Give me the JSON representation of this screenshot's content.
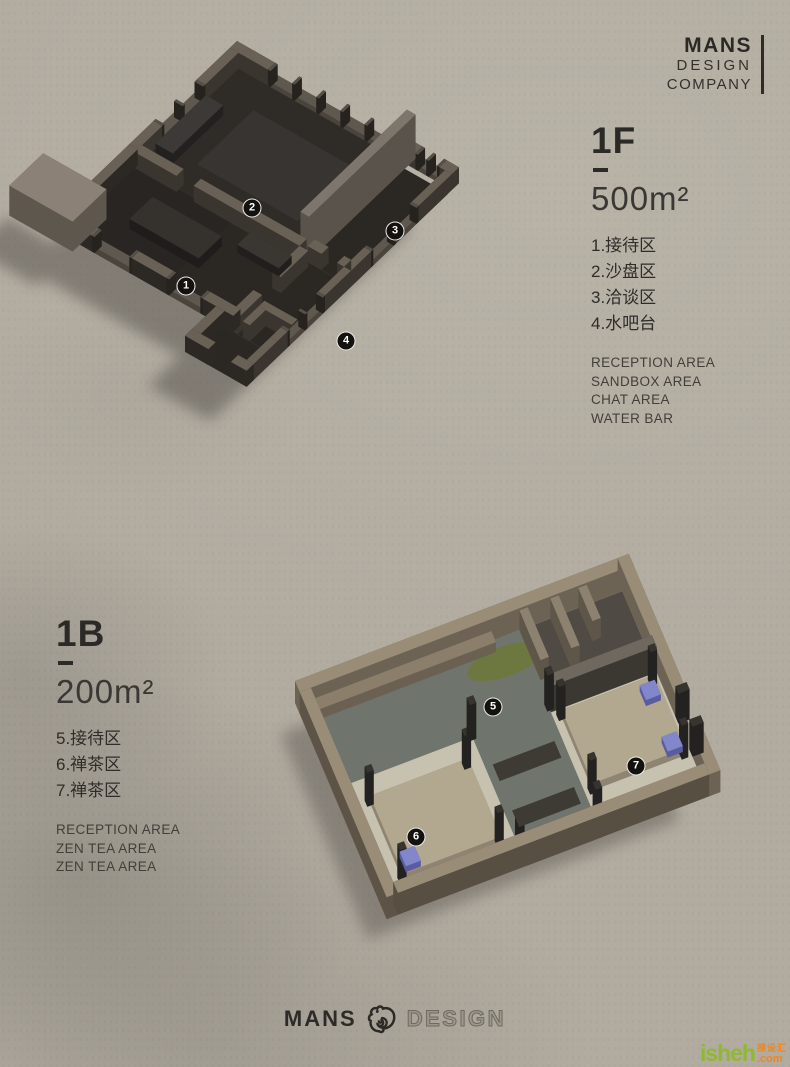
{
  "logo_top": {
    "line1": "MANS",
    "line2": "DESIGN",
    "line3": "COMPANY"
  },
  "floor1": {
    "code": "1F",
    "area": "500m²",
    "items_cn": [
      "1.接待区",
      "2.沙盘区",
      "3.洽谈区",
      "4.水吧台"
    ],
    "items_en": [
      "RECEPTION AREA",
      "SANDBOX AREA",
      "CHAT AREA",
      "WATER BAR"
    ]
  },
  "floor2": {
    "code": "1B",
    "area": "200m²",
    "items_cn": [
      "5.接待区",
      "6.禅茶区",
      "7.禅茶区"
    ],
    "items_en": [
      "RECEPTION AREA",
      "ZEN TEA AREA",
      "ZEN TEA AREA"
    ]
  },
  "footer": {
    "brand": "MANS",
    "brand2": "DESIGN",
    "icon": "chameleon-logo"
  },
  "watermark": {
    "main": "isheh",
    "tld": ".com",
    "cn": "搜设汇"
  },
  "colors": {
    "paper": "#b1aba0",
    "ink": "#2c2a27",
    "marker_bg": "#14120f",
    "wm_green": "#8fb92e",
    "wm_orange": "#f0861c"
  },
  "markers": [
    {
      "n": "1",
      "x": 186,
      "y": 286
    },
    {
      "n": "2",
      "x": 252,
      "y": 208
    },
    {
      "n": "3",
      "x": 395,
      "y": 231
    },
    {
      "n": "4",
      "x": 346,
      "y": 341
    },
    {
      "n": "5",
      "x": 493,
      "y": 707
    },
    {
      "n": "6",
      "x": 416,
      "y": 837
    },
    {
      "n": "7",
      "x": 636,
      "y": 766
    }
  ],
  "plans": [
    {
      "name": "floor-plan-1f",
      "origin": [
        237,
        57
      ],
      "u": [
        0.867,
        0.493
      ],
      "v": [
        -0.72,
        0.69
      ],
      "shadow": {
        "dx": -36,
        "dy": 34,
        "color": "#46423c",
        "opacity": 0.45
      },
      "colors": {
        "side": "#3a352f",
        "top": "#6a6156",
        "sillSide": "#4a443c",
        "sillTop": "#5f584f",
        "postSide": "#26231f",
        "postTop": "#55504a"
      },
      "shapes": [
        {
          "t": "slab",
          "r": [
            8,
            8,
            200,
            150
          ],
          "f": "#2f2c28",
          "sh": 1
        },
        {
          "t": "slab",
          "r": [
            200,
            15,
            256,
            150
          ],
          "f": "#2b2824",
          "sh": 1
        },
        {
          "t": "slab",
          "r": [
            8,
            150,
            205,
            252
          ],
          "f": "#282522",
          "sh": 1
        },
        {
          "t": "slab",
          "r": [
            120,
            150,
            256,
            252
          ],
          "f": "#2b2824",
          "sh": 1
        },
        {
          "t": "slab",
          "r": [
            185,
            252,
            256,
            295
          ],
          "f": "#2b2824",
          "sh": 1
        },
        {
          "t": "slab",
          "r": [
            52,
            40,
            168,
            118
          ],
          "f": "#373431"
        },
        {
          "t": "box",
          "r": [
            0,
            0,
            44,
            10
          ],
          "h": 16
        },
        {
          "t": "fence",
          "r": [
            44,
            0,
            186,
            10
          ],
          "sill": 5,
          "n": 6,
          "h": 16
        },
        {
          "t": "box",
          "r": [
            186,
            0,
            214,
            10
          ],
          "h": 16
        },
        {
          "t": "fence",
          "r": [
            214,
            0,
            242,
            10
          ],
          "sill": 5,
          "n": 3,
          "h": 16
        },
        {
          "t": "box",
          "r": [
            242,
            0,
            256,
            10
          ],
          "h": 16
        },
        {
          "t": "box",
          "r": [
            0,
            10,
            10,
            56
          ],
          "h": 16
        },
        {
          "t": "fence",
          "r": [
            0,
            56,
            10,
            116
          ],
          "sill": 5,
          "n": 3,
          "h": 16
        },
        {
          "t": "box",
          "r": [
            0,
            116,
            10,
            150
          ],
          "h": 16
        },
        {
          "t": "box",
          "r": [
            248,
            10,
            256,
            56
          ],
          "h": 16
        },
        {
          "t": "fence",
          "r": [
            248,
            56,
            256,
            122
          ],
          "sill": 6,
          "n": 3,
          "h": 16
        },
        {
          "t": "box",
          "r": [
            248,
            122,
            256,
            150
          ],
          "h": 16
        },
        {
          "t": "box",
          "r": [
            14,
            60,
            34,
            130
          ],
          "h": 10,
          "side": "#232120",
          "top": "#3c3936"
        },
        {
          "t": "box",
          "r": [
            196,
            0,
            206,
            148
          ],
          "h": 44,
          "side": "#59534c",
          "top": "#7d766c"
        },
        {
          "t": "box",
          "r": [
            8,
            144,
            58,
            154
          ],
          "h": 16
        },
        {
          "t": "box",
          "r": [
            78,
            144,
            200,
            154
          ],
          "h": 16
        },
        {
          "t": "box",
          "r": [
            206,
            140,
            222,
            150
          ],
          "h": 16
        },
        {
          "t": "box",
          "r": [
            240,
            140,
            248,
            150
          ],
          "h": 16
        },
        {
          "t": "box",
          "r": [
            200,
            154,
            210,
            192
          ],
          "h": 16
        },
        {
          "t": "box",
          "r": [
            200,
            218,
            210,
            252
          ],
          "h": 16
        },
        {
          "t": "box",
          "r": [
            216,
            222,
            254,
            230
          ],
          "h": 16
        },
        {
          "t": "box",
          "r": [
            216,
            230,
            224,
            252
          ],
          "h": 16
        },
        {
          "t": "box",
          "r": [
            52,
            180,
            132,
            212
          ],
          "h": 10,
          "side": "#1f1d1b",
          "top": "#35322e"
        },
        {
          "t": "box",
          "r": [
            148,
            160,
            196,
            178
          ],
          "h": 8,
          "side": "#211f1d",
          "top": "#3a3733"
        },
        {
          "t": "box",
          "r": [
            0,
            150,
            10,
            252
          ],
          "h": 16,
          "side": "#2c2925"
        },
        {
          "t": "box",
          "r": [
            0,
            242,
            42,
            252
          ],
          "h": 16,
          "side": "#2c2925"
        },
        {
          "t": "fence",
          "r": [
            42,
            242,
            88,
            252
          ],
          "sill": 6,
          "n": 2,
          "h": 16
        },
        {
          "t": "box",
          "r": [
            88,
            242,
            128,
            252
          ],
          "h": 16,
          "side": "#2c2925"
        },
        {
          "t": "fence",
          "r": [
            128,
            242,
            170,
            252
          ],
          "sill": 6,
          "n": 2,
          "h": 16
        },
        {
          "t": "box",
          "r": [
            170,
            242,
            205,
            252
          ],
          "h": 16,
          "side": "#2c2925"
        },
        {
          "t": "box",
          "r": [
            248,
            150,
            256,
            186
          ],
          "h": 16
        },
        {
          "t": "fence",
          "r": [
            248,
            186,
            256,
            238
          ],
          "sill": 6,
          "n": 3,
          "h": 16
        },
        {
          "t": "box",
          "r": [
            248,
            238,
            256,
            252
          ],
          "h": 16
        },
        {
          "t": "box",
          "r": [
            248,
            252,
            256,
            295
          ],
          "h": 16
        },
        {
          "t": "box",
          "r": [
            185,
            252,
            195,
            295
          ],
          "h": 16,
          "side": "#2c2925"
        },
        {
          "t": "box",
          "r": [
            185,
            285,
            212,
            295
          ],
          "h": 16,
          "side": "#2c2925"
        },
        {
          "t": "box",
          "r": [
            238,
            285,
            256,
            295
          ],
          "h": 16,
          "side": "#2c2925"
        },
        {
          "t": "box",
          "r": [
            -45,
            215,
            28,
            262
          ],
          "h": 30,
          "side": "#5e574d",
          "top": "#8b8177",
          "sh": 1
        }
      ]
    },
    {
      "name": "floor-plan-1b",
      "origin": [
        295,
        703
      ],
      "u": [
        0.935,
        -0.356
      ],
      "v": [
        0.39,
        0.92
      ],
      "shadow": {
        "dx": -30,
        "dy": 24,
        "color": "#46423c",
        "opacity": 0.38
      },
      "colors": {
        "side": "#6d6354",
        "top": "#9a8d78",
        "sillSide": "#6d6354",
        "sillTop": "#9a8d78",
        "postSide": "#242220",
        "postTop": "#37342f"
      },
      "shapes": [
        {
          "t": "slab",
          "r": [
            12,
            12,
            345,
            95
          ],
          "f": "#6f746c",
          "sh": 1
        },
        {
          "t": "slab",
          "r": [
            150,
            95,
            232,
            235
          ],
          "f": "#6f746c",
          "sh": 1
        },
        {
          "t": "slab",
          "r": [
            12,
            95,
            150,
            235
          ],
          "f": "#c7c1b0",
          "sh": 1
        },
        {
          "t": "slab",
          "r": [
            232,
            95,
            345,
            235
          ],
          "f": "#c7c1b0",
          "sh": 1
        },
        {
          "t": "slab",
          "r": [
            240,
            12,
            345,
            66
          ],
          "f": "#4f4a43"
        },
        {
          "t": "oval",
          "c": [
            210,
            36
          ],
          "rx": 40,
          "ry": 15,
          "f": "#6d7840"
        },
        {
          "t": "box",
          "r": [
            0,
            0,
            357,
            12
          ],
          "h": 22
        },
        {
          "t": "box",
          "r": [
            12,
            12,
            205,
            24
          ],
          "h": 10,
          "side": "#6b6153",
          "top": "#8b7f6b"
        },
        {
          "t": "box",
          "r": [
            235,
            12,
            244,
            66
          ],
          "h": 20,
          "side": "#5f564a",
          "top": "#8d8170"
        },
        {
          "t": "box",
          "r": [
            268,
            12,
            277,
            66
          ],
          "h": 20,
          "side": "#5f564a",
          "top": "#8d8170"
        },
        {
          "t": "box",
          "r": [
            298,
            12,
            307,
            48
          ],
          "h": 20,
          "side": "#5f564a",
          "top": "#8d8170"
        },
        {
          "t": "box",
          "r": [
            345,
            0,
            357,
            148
          ],
          "h": 22
        },
        {
          "t": "box",
          "r": [
            345,
            192,
            357,
            235
          ],
          "h": 22
        },
        {
          "t": "box",
          "r": [
            345,
            148,
            357,
            156
          ],
          "h": 30,
          "side": "#242220",
          "top": "#37342f"
        },
        {
          "t": "box",
          "r": [
            345,
            184,
            357,
            192
          ],
          "h": 30,
          "side": "#242220",
          "top": "#37342f"
        },
        {
          "t": "box",
          "r": [
            232,
            88,
            345,
            100
          ],
          "h": 26,
          "side": "#3b3731",
          "top": "#6f685f"
        },
        {
          "t": "box",
          "r": [
            30,
            120,
            135,
            205
          ],
          "h": 7,
          "side": "#8f8471",
          "top": "#b2a78f"
        },
        {
          "t": "box",
          "r": [
            240,
            108,
            340,
            188
          ],
          "h": 7,
          "side": "#8f8471",
          "top": "#b2a78f"
        },
        {
          "t": "box",
          "r": [
            26,
            116,
            33,
            123
          ],
          "h": 34,
          "side": "#242220",
          "top": "#37342f"
        },
        {
          "t": "box",
          "r": [
            130,
            116,
            137,
            123
          ],
          "h": 34,
          "side": "#242220",
          "top": "#37342f"
        },
        {
          "t": "box",
          "r": [
            26,
            200,
            33,
            207
          ],
          "h": 34,
          "side": "#242220",
          "top": "#37342f"
        },
        {
          "t": "box",
          "r": [
            130,
            200,
            137,
            207
          ],
          "h": 34,
          "side": "#242220",
          "top": "#37342f"
        },
        {
          "t": "box",
          "r": [
            236,
            104,
            243,
            111
          ],
          "h": 34,
          "side": "#242220",
          "top": "#37342f"
        },
        {
          "t": "box",
          "r": [
            334,
            104,
            341,
            111
          ],
          "h": 34,
          "side": "#242220",
          "top": "#37342f"
        },
        {
          "t": "box",
          "r": [
            236,
            184,
            243,
            191
          ],
          "h": 34,
          "side": "#242220",
          "top": "#37342f"
        },
        {
          "t": "box",
          "r": [
            334,
            184,
            341,
            191
          ],
          "h": 34,
          "side": "#242220",
          "top": "#37342f"
        },
        {
          "t": "box",
          "r": [
            146,
            90,
            153,
            98
          ],
          "h": 36,
          "side": "#242220",
          "top": "#37342f"
        },
        {
          "t": "box",
          "r": [
            229,
            90,
            236,
            98
          ],
          "h": 36,
          "side": "#242220",
          "top": "#37342f"
        },
        {
          "t": "box",
          "r": [
            146,
            214,
            153,
            222
          ],
          "h": 36,
          "side": "#242220",
          "top": "#37342f"
        },
        {
          "t": "box",
          "r": [
            229,
            214,
            236,
            222
          ],
          "h": 36,
          "side": "#242220",
          "top": "#37342f"
        },
        {
          "t": "box",
          "r": [
            36,
            182,
            52,
            198
          ],
          "h": 6,
          "side": "#595da0",
          "top": "#8287cb"
        },
        {
          "t": "box",
          "r": [
            322,
            112,
            338,
            128
          ],
          "h": 6,
          "side": "#595da0",
          "top": "#8287cb"
        },
        {
          "t": "box",
          "r": [
            322,
            168,
            338,
            184
          ],
          "h": 6,
          "side": "#595da0",
          "top": "#8287cb"
        },
        {
          "t": "slab",
          "r": [
            158,
            128,
            224,
            146
          ],
          "f": "#3e3a34"
        },
        {
          "t": "slab",
          "r": [
            158,
            178,
            224,
            196
          ],
          "f": "#3e3a34"
        },
        {
          "t": "slab",
          "r": [
            160,
            215,
            222,
            232
          ],
          "f": "#9a9184"
        },
        {
          "t": "box",
          "r": [
            0,
            12,
            12,
            235
          ],
          "h": 22,
          "side": "#5d5447"
        },
        {
          "t": "box",
          "r": [
            12,
            223,
            345,
            235
          ],
          "h": 22,
          "side": "#584f43"
        }
      ]
    }
  ]
}
